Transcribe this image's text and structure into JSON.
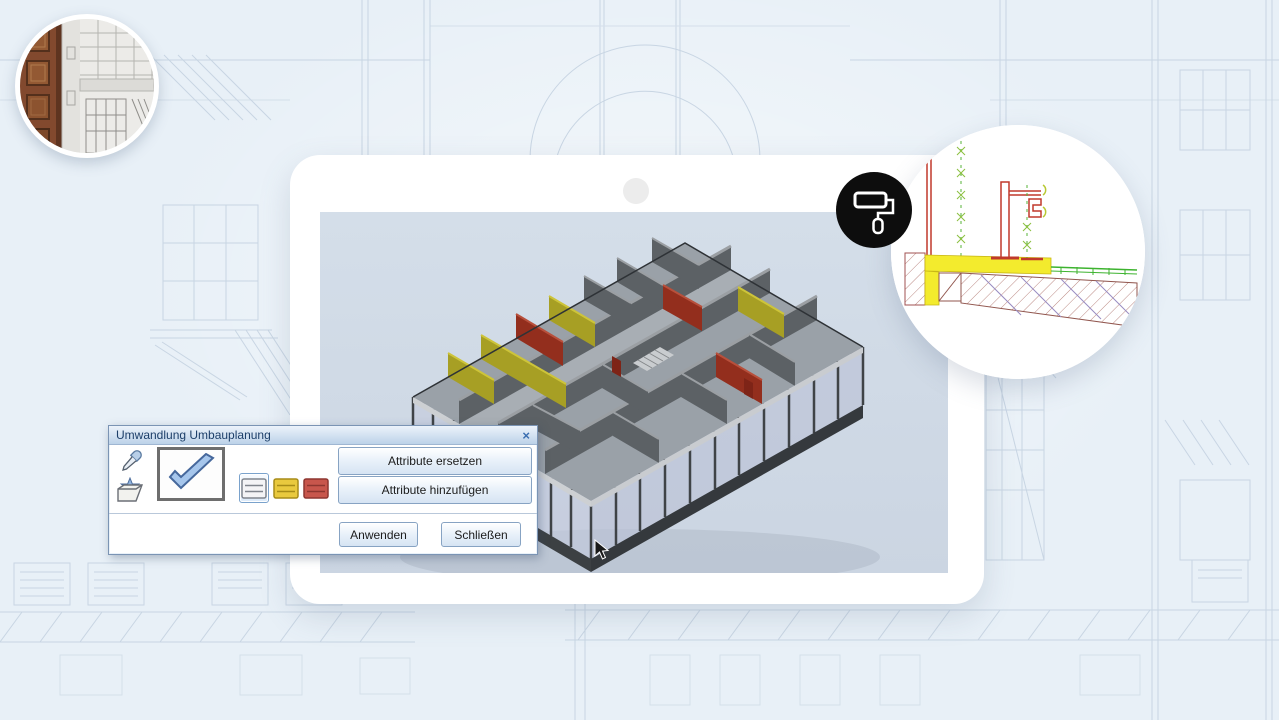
{
  "palette": {
    "page_bg": "#e8f0f7",
    "sketch_line": "#c8d5e3",
    "tablet_frame": "#ffffff",
    "screen_bg": "#cfd9e5",
    "badge_bg": "#0d0d0d",
    "model_wall_gray": "#5c6165",
    "model_wall_yellow": "#a79f24",
    "model_wall_red": "#932e1d",
    "cad_highlight_yellow": "#f3eb2d",
    "cad_red": "#c0392b",
    "cad_green": "#3db32f",
    "dialog_title_text": "#1d3f69"
  },
  "dialog": {
    "title": "Umwandlung Umbauplanung",
    "close_glyph": "×",
    "buttons": {
      "replace": "Attribute ersetzen",
      "add": "Attribute hinzufügen",
      "apply": "Anwenden",
      "close": "Schließen"
    },
    "icons": [
      "pipette",
      "folder-favorite",
      "confirm-check",
      "wall-existing",
      "wall-new-yellow",
      "wall-demolition-red"
    ]
  },
  "badges": {
    "paint_roller": "paint-roller"
  },
  "insets": {
    "photo": "facade-photo-with-door",
    "detail": "cad-section-detail"
  }
}
